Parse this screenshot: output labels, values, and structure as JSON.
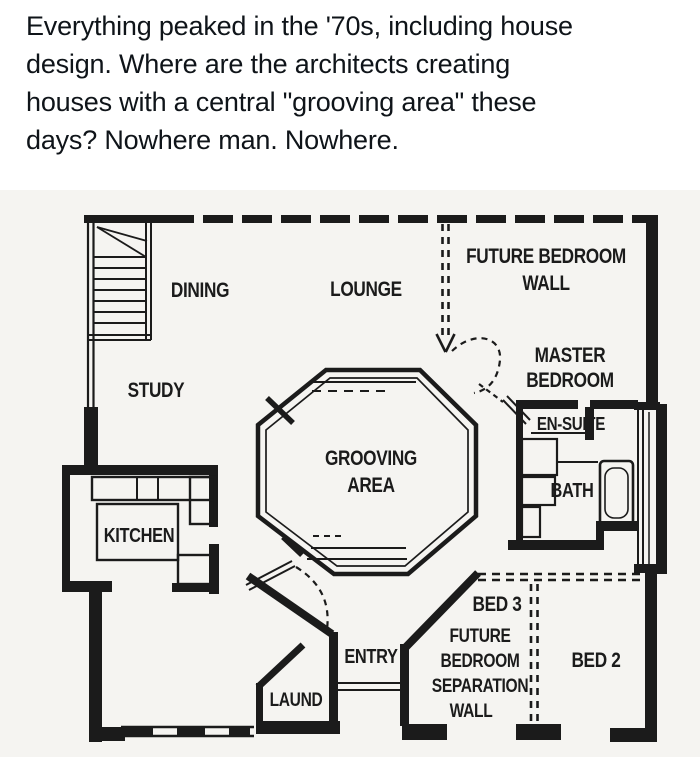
{
  "post": {
    "caption_lines": [
      "Everything peaked in the '70s, including house",
      "design. Where are the architects creating",
      "houses with a central \"grooving area\" these",
      "days? Nowhere man. Nowhere."
    ]
  },
  "floor_plan": {
    "rooms": {
      "dining": "DINING",
      "lounge": "LOUNGE",
      "future_wall_line1": "FUTURE BEDROOM",
      "future_wall_line2": "WALL",
      "study": "STUDY",
      "master_line1": "MASTER",
      "master_line2": "BEDROOM",
      "ensuite": "EN-SUITE",
      "grooving_line1": "GROOVING",
      "grooving_line2": "AREA",
      "bath": "BATH",
      "kitchen": "KITCHEN",
      "bed3": "BED 3",
      "sep_line1": "FUTURE",
      "sep_line2": "BEDROOM",
      "sep_line3": "SEPARATION",
      "sep_line4": "WALL",
      "bed2": "BED 2",
      "entry": "ENTRY",
      "laundry": "LAUND"
    },
    "colors": {
      "ink": "#1b1b1b",
      "paper": "#f5f4f1"
    }
  }
}
